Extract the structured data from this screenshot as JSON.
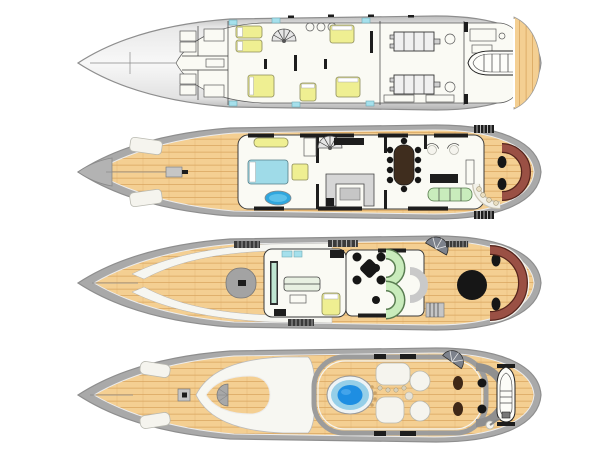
{
  "page": {
    "background": "#ffffff",
    "kind": "yacht-deck-plan-drawing"
  },
  "palette": {
    "hull-outline": "#8e8e8e",
    "hull-light": "#f6f6f6",
    "hull-mid": "#dcdcdc",
    "hull-dark": "#a6a6a6",
    "rim-gray": "#a9a9a9",
    "wood": "#f4cf92",
    "wood-line": "#d9a55f",
    "interior-white": "#fafaf4",
    "wall-dark": "#1d1d1d",
    "bed-yellow": "#efef92",
    "bath-cyan": "#a5e0ec",
    "tub-blue": "#30a7de",
    "sofa-green": "#c9ecbc",
    "seat-maroon": "#9a5044",
    "table-black": "#161616",
    "jacuzzi-rim": "#96cfe8",
    "jacuzzi-blue": "#1e8ee2",
    "console-teal": "#bfe6d2",
    "furniture-gray": "#c6c6c6"
  },
  "decks": [
    {
      "id": "lower-deck",
      "label": "Lower deck",
      "features": [
        "crew quarters",
        "guest cabins with beds",
        "spiral staircase",
        "engine room",
        "tender garage",
        "swim platform"
      ]
    },
    {
      "id": "main-deck",
      "label": "Main deck",
      "features": [
        "foredeck hatches",
        "owner stateroom with bed and bathtub",
        "galley",
        "dining table",
        "salon sofa",
        "aft deck curved sofa",
        "boarding ladders"
      ]
    },
    {
      "id": "bridge-deck",
      "label": "Bridge deck",
      "features": [
        "wheelhouse console",
        "captain cabin",
        "game table",
        "curved green sofas",
        "bar",
        "aft round table",
        "umbrella",
        "aft curved sofa"
      ]
    },
    {
      "id": "sun-deck",
      "label": "Sun deck",
      "features": [
        "foredeck pads",
        "jacuzzi pool",
        "bar with stools",
        "round sofas",
        "umbrella",
        "mast housing",
        "stowed tender",
        "crane"
      ]
    }
  ]
}
